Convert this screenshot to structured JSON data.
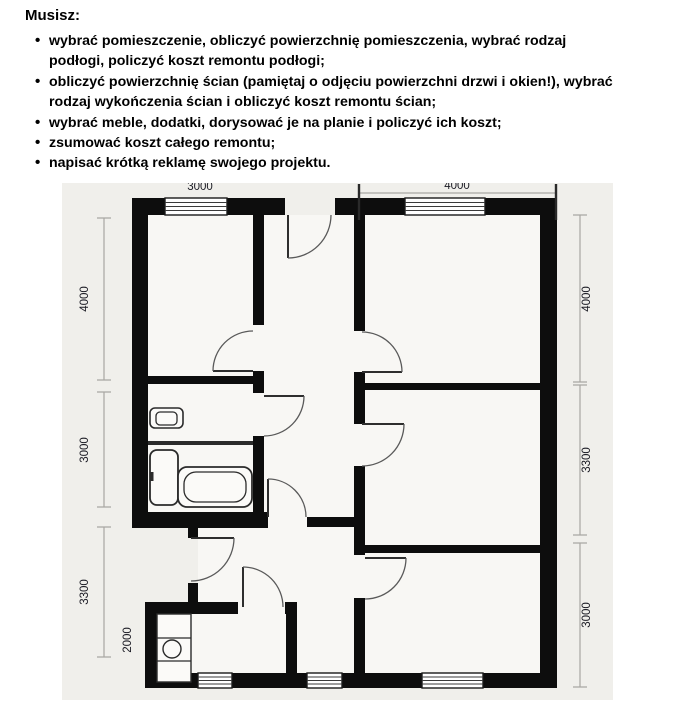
{
  "instructions": {
    "title": "Musisz:",
    "items": [
      {
        "lines": [
          "wybrać pomieszczenie, obliczyć powierzchnię pomieszczenia, wybrać rodzaj",
          "podłogi, policzyć koszt remontu podłogi;"
        ]
      },
      {
        "lines": [
          "obliczyć powierzchnię ścian (pamiętaj o odjęciu powierzchni drzwi i okien!), wybrać",
          "rodzaj wykończenia ścian i obliczyć koszt remontu ścian;"
        ]
      },
      {
        "lines": [
          "wybrać meble, dodatki, dorysować je na planie i policzyć ich koszt;"
        ]
      },
      {
        "lines": [
          "zsumować koszt całego remontu;"
        ]
      },
      {
        "lines": [
          "napisać krótką reklamę swojego projektu."
        ]
      }
    ]
  },
  "floor_plan": {
    "background": "#f0efeb",
    "room_fill": "#f8f7f4",
    "wall_color": "#0d0d0d",
    "dimension_line_color": "#a8a6a2",
    "dimensions": {
      "top": [
        "3000",
        "4000"
      ],
      "left": [
        "4000",
        "3000",
        "3300",
        "2000"
      ],
      "right": [
        "4000",
        "3300",
        "3000"
      ]
    },
    "fixtures": [
      "toilet",
      "bathroom-counter",
      "washing-machine",
      "bathtub",
      "kitchen-unit-with-sink"
    ],
    "features": [
      "entrance-door",
      "interior-doors",
      "windows"
    ]
  }
}
